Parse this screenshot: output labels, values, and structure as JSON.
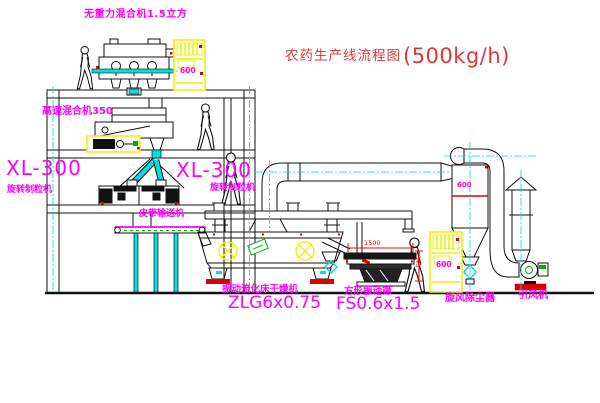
{
  "title": {
    "name": "农药生产线流程图",
    "capacity": "(500kg/h)"
  },
  "equipment": {
    "gravity_mixer_label": "无重力混合机1.5立方",
    "high_speed_mixer_label": "高速混合机350",
    "granulator_left": {
      "model": "XL-300",
      "name": "旋转制粒机"
    },
    "granulator_right": {
      "model": "XL-300",
      "name": "旋转制粒机"
    },
    "belt_conveyor_label": "皮带输送机",
    "dryer": {
      "name": "振动流化床干燥机",
      "model": "ZLG6x0.75"
    },
    "sieve": {
      "name": "方形振动筛",
      "model": "FS0.6x1.5",
      "dim_width": "1500",
      "dim_height": "345"
    },
    "cyclone": {
      "name": "旋风除尘器",
      "size": "600"
    },
    "fan": {
      "name": "引风机"
    },
    "cabinet1_display": "600",
    "cabinet2_display": "600"
  },
  "colors": {
    "label_magenta": "#ff00ff",
    "title_red": "#e03838",
    "dimension_red": "#ff0000",
    "pipe_cyan": "#00e0e0",
    "highlight_yellow": "#f5f500",
    "accent_green": "#00b000"
  }
}
